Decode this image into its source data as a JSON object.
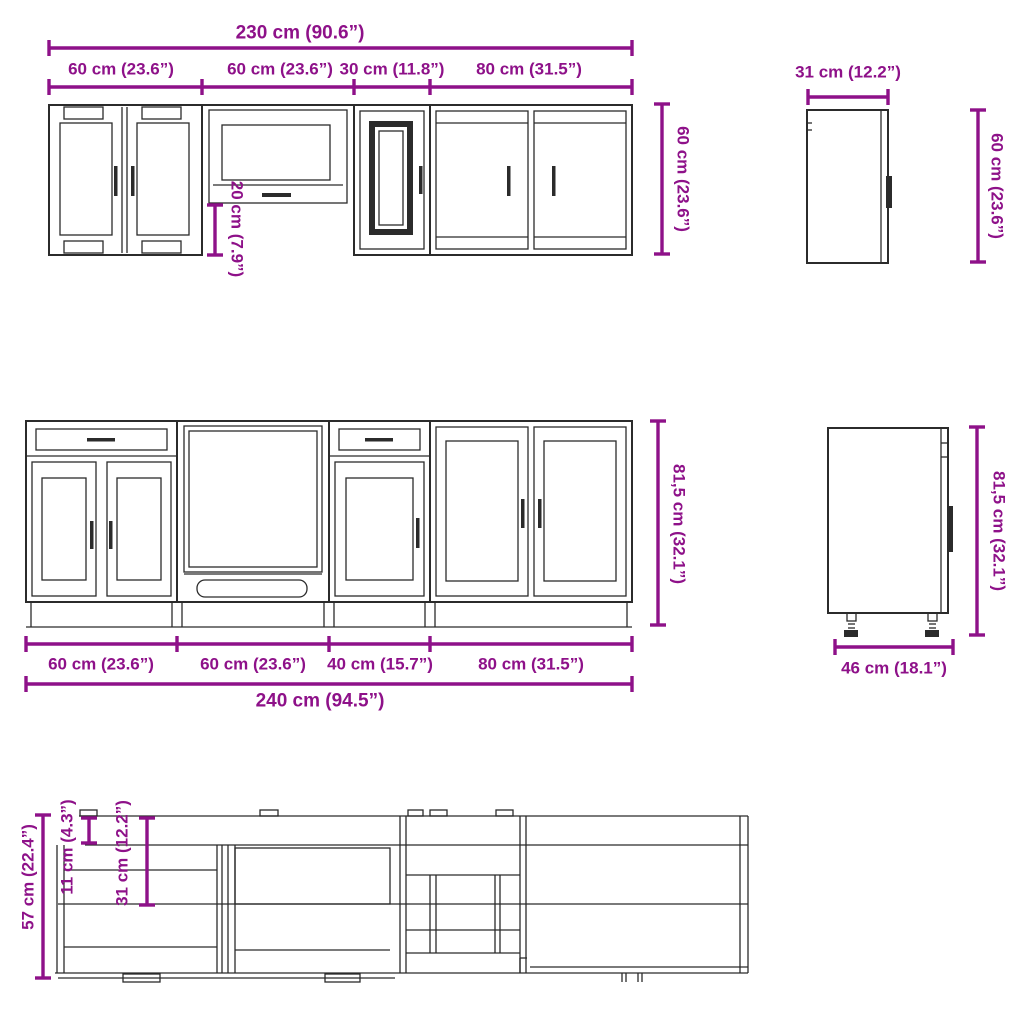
{
  "colors": {
    "dimension": "#8e1189",
    "line": "#2b2b2b",
    "background": "#ffffff"
  },
  "wall_cabinets": {
    "total_width": "230 cm (90.6”)",
    "segments": [
      "60 cm (23.6”)",
      "60 cm (23.6”)",
      "30 cm (11.8”)",
      "80 cm (31.5”)"
    ],
    "height": "60 cm (23.6”)",
    "hood_clearance": "20 cm (7.9”)",
    "side": {
      "depth": "31 cm (12.2”)",
      "height": "60 cm (23.6”)"
    }
  },
  "base_cabinets": {
    "total_width": "240 cm (94.5”)",
    "segments": [
      "60 cm (23.6”)",
      "60 cm (23.6”)",
      "40 cm (15.7”)",
      "80 cm (31.5”)"
    ],
    "height": "81,5 cm (32.1”)",
    "side": {
      "depth": "46 cm (18.1”)",
      "height": "81,5 cm (32.1”)"
    }
  },
  "top_view": {
    "total_depth": "57 cm (22.4”)",
    "overhang": "11 cm (4.3”)",
    "counter_depth": "31 cm (12.2”)"
  }
}
